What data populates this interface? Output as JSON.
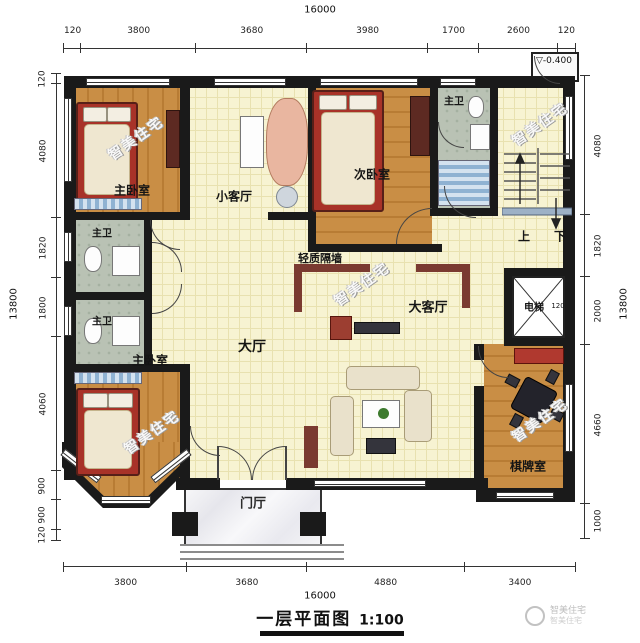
{
  "title": {
    "name": "一层平面图",
    "scale": "1:100"
  },
  "watermark": {
    "text": "智美住宅"
  },
  "logo": {
    "line1": "智美住宅",
    "line2": "智美住宅"
  },
  "level_marker": {
    "symbol": "▽",
    "value": "-0.400"
  },
  "rooms": {
    "master_bedroom_top": "主卧室",
    "master_bedroom_low": "主卧室",
    "small_living": "小客厅",
    "second_bedroom": "次卧室",
    "bath_top": "主卫",
    "bath_mid1": "主卫",
    "bath_mid2": "主卫",
    "main_hall": "大厅",
    "large_living": "大客厅",
    "elevator": "电梯",
    "elevator_width": "120",
    "mahjong_room": "棋牌室",
    "foyer": "门厅",
    "partition_note": "轻质隔墙",
    "stairs_up": "上",
    "stairs_down": "下"
  },
  "dims": {
    "top": {
      "total": "16000",
      "segs": [
        "120",
        "3800",
        "3680",
        "3980",
        "1700",
        "2600",
        "120"
      ]
    },
    "bottom": {
      "total": "16000",
      "segs": [
        "3800",
        "3680",
        "4880",
        "3400"
      ]
    },
    "left": {
      "total": "13800",
      "segs": [
        "120",
        "4080",
        "1820",
        "1800",
        "4060",
        "900",
        "900",
        "120"
      ]
    },
    "right": {
      "total": "13800",
      "segs": [
        "4080",
        "1820",
        "2000",
        "4660",
        "1000"
      ]
    }
  },
  "colors": {
    "wall": "#1a1a1a",
    "partition_red": "#7a3a31",
    "tile": "#f7f3d2",
    "wood": "#c98e45",
    "bath": "#b9c2b4",
    "accent_blue": "#8fb2d2"
  }
}
